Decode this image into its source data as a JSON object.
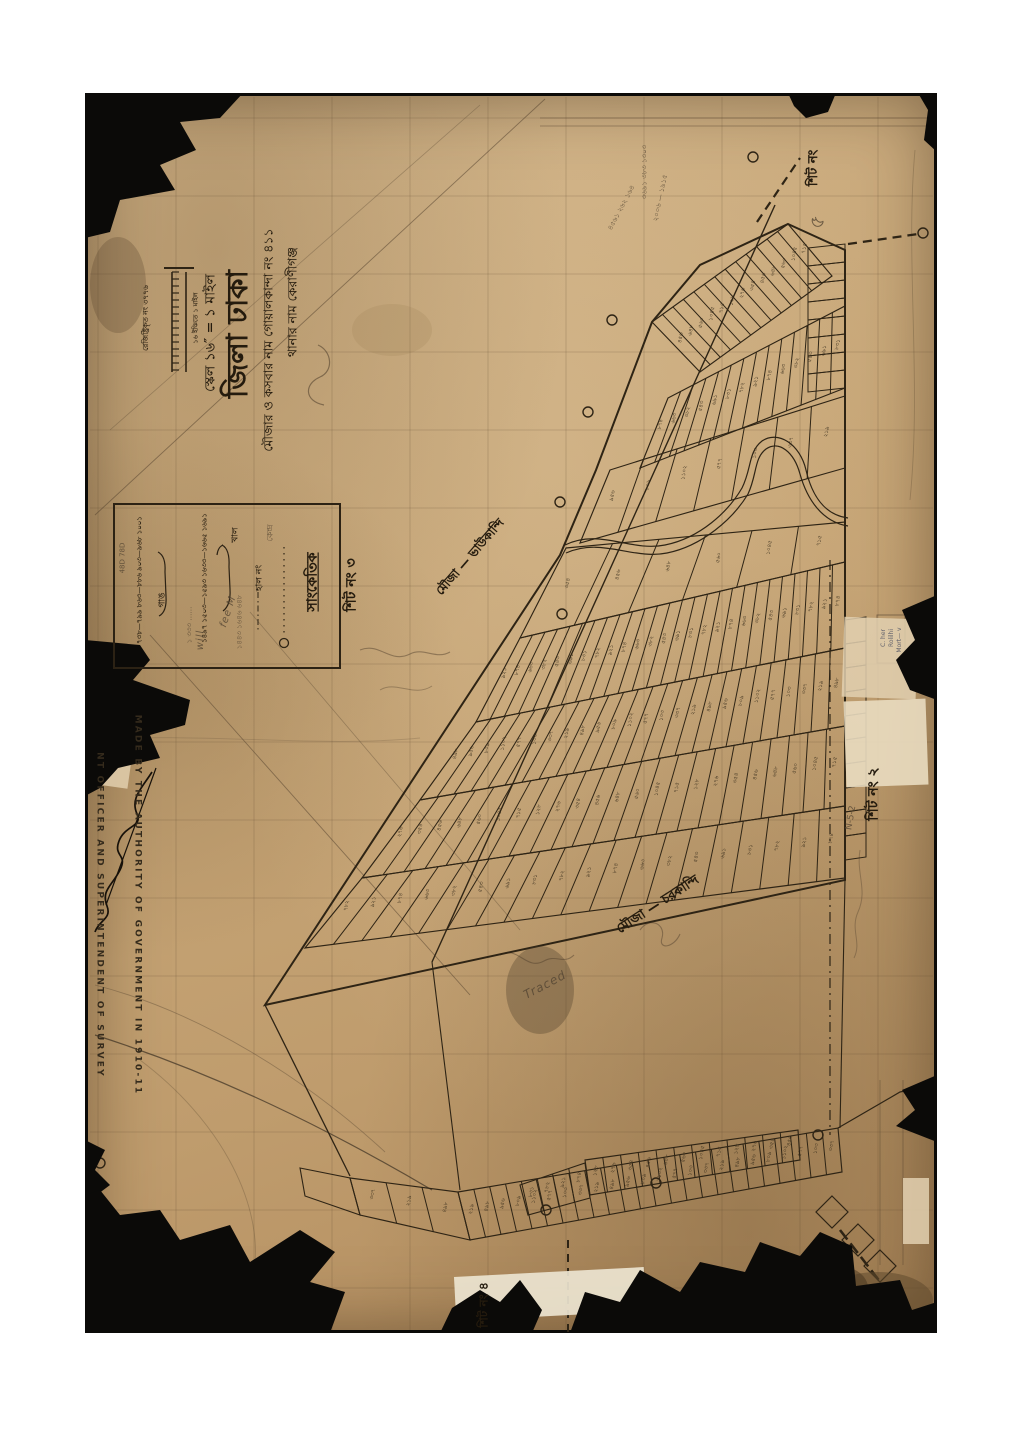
{
  "title_block": {
    "thana_line": "থানার নাম কেরাণীগঞ্জ",
    "mouza_line": "মৌজার ও কসবার নাম গোয়ালকান্দা নং ৪১১",
    "district_line": "জিলা ঢাকা",
    "scale_line": "স্কেল ১৬″ = ১ মাইল"
  },
  "registration_note": "রেজিষ্ট্রিকৃত নং ৩৭৭৬",
  "scale_bar_note": "১৬ ইঞ্চিতে ১ মাইল",
  "sheet_labels": {
    "top_right_ink": "শিট নং",
    "top_right_pencil": "৫",
    "center": "শিট নং ৩",
    "right": "শিট নং ২",
    "bottom": "শিট নং ৪"
  },
  "legend": {
    "title": "সাংকেতিক",
    "station_label": "কেন্দ্র",
    "current_no_label": "হাল নং",
    "group_a_label": "গাঙ",
    "group_a_numbers": "৭৩৮—৭৯৯  ৮৬৩—৮৮৬  ৯০৩—৯৬৮  ১০০১",
    "group_b_label": "খাল",
    "group_b_numbers": "১৪৯৭  ১৫০৩—১৫৯৩  ১৬৩৩—১৬৬৫  ১৬৯১"
  },
  "mouza_labels": {
    "upper": "মৌজা — ভাউকান্দি",
    "lower": "মৌজা — চরকান্দি"
  },
  "stamp": {
    "line1": "MADE BY THE AUTHORITY OF GOVERNMENT IN 1910-11",
    "line2": "NT OFFICER AND SUPERINTENDENT OF SURVEY"
  },
  "stamp_box": {
    "line1": "C. her",
    "line2": "Rolilhi",
    "line3": "Mort— v"
  },
  "pencil_notes": {
    "calc1": "৩৬৯১ ৩৮৩ ১৩০৩",
    "calc2": "২০০৬ — ১৯১৫",
    "calc3": "৪৫৬১ ২৬২ ১৬৪",
    "sheet2_note": "N-5-2",
    "legend_note1": "১৪৪৩ ১৬৪৬ ৬৪৮",
    "legend_note2": "১ ৩৩৩ ……",
    "legend_note3": "48D 78D",
    "cursive1": "will",
    "cursive2": "fee M",
    "cursive3": "Traced"
  },
  "plot_number_samples": [
    "৪৫৬",
    "৭৮২",
    "১০৩",
    "৬৪৮",
    "৯২১",
    "৩৩৭",
    "৫৬০",
    "৮৭৪",
    "২১৯",
    "১০৪৫",
    "৬৬৩",
    "৪৯৮",
    "৭১৫",
    "৩৮২",
    "৯৫৬",
    "১২৮",
    "৫৪৩",
    "৮০৯",
    "২৭৬",
    "৬৯১",
    "১১০২",
    "৩৫৪",
    "৮৩১",
    "৫৭৭"
  ]
}
